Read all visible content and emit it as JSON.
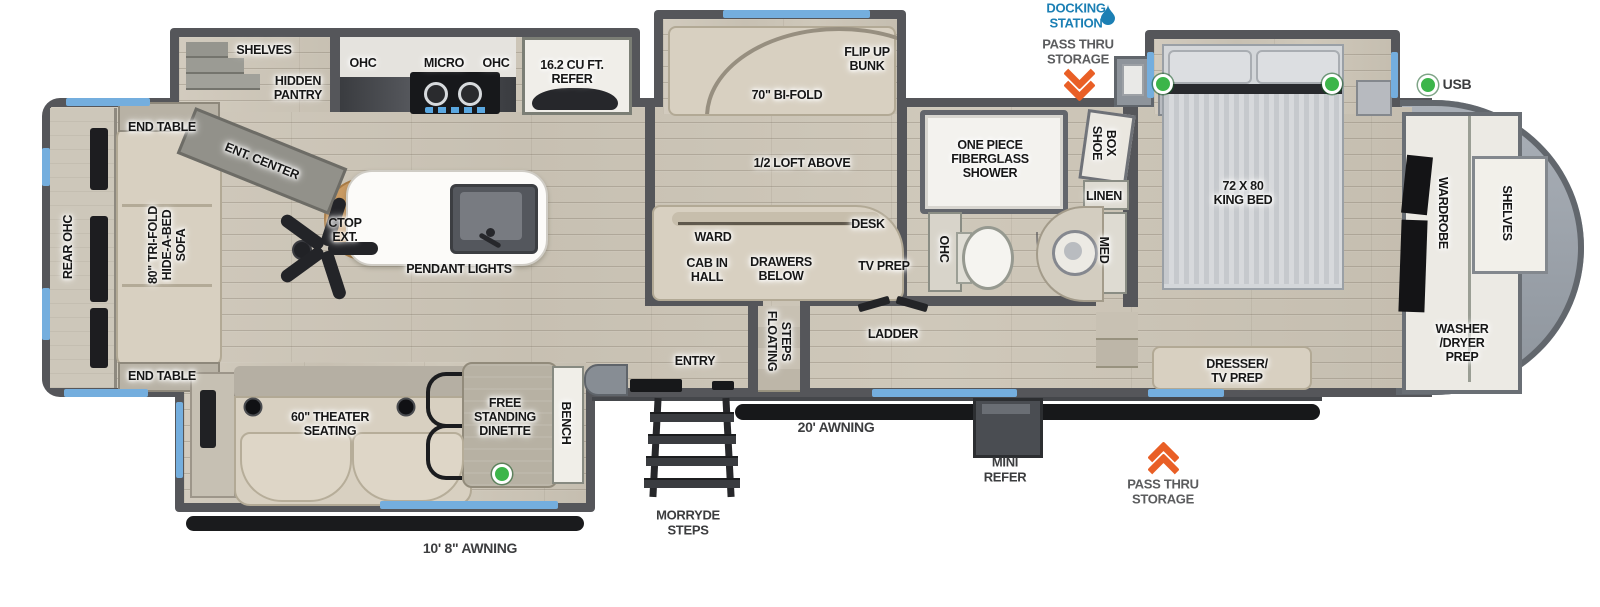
{
  "colors": {
    "window_blue": "#74aede",
    "docking_blue": "#1b7fb4",
    "accent_orange": "#e95f26",
    "indicator_green": "#3cb54a",
    "annotation_gray": "#5b5c5e",
    "wall_gray": "#55565a"
  },
  "icons": {
    "docking_station": "water-drop",
    "pass_thru_storage": "double-chevron-arrow",
    "power_indicator": "green-dot"
  },
  "labels": {
    "shelves": "SHELVES",
    "hidden_pantry": "HIDDEN\nPANTRY",
    "ent_center": "ENT. CENTER",
    "ohc_left": "OHC",
    "micro": "MICRO",
    "ohc_right": "OHC",
    "refer": "16.2 CU FT.\nREFER",
    "end_table_top": "END TABLE",
    "rear_ohc": "REAR OHC",
    "sofa": "80\" TRI-FOLD\nHIDE-A-BED\nSOFA",
    "end_table_bottom": "END TABLE",
    "ctop_ext": "CTOP\nEXT.",
    "pendant_lights": "PENDANT LIGHTS",
    "flip_up_bunk": "FLIP UP\nBUNK",
    "bi_fold": "70\" BI-FOLD",
    "loft_above": "1/2 LOFT ABOVE",
    "ward": "WARD",
    "cab_in_hall": "CAB IN\nHALL",
    "drawers_below": "DRAWERS\nBELOW",
    "desk": "DESK",
    "tv_prep": "TV PREP",
    "floating_steps": "FLOATING\nSTEPS",
    "ladder": "LADDER",
    "entry": "ENTRY",
    "shower": "ONE PIECE\nFIBERGLASS\nSHOWER",
    "shoe_box": "SHOE\nBOX",
    "linen": "LINEN",
    "ohc_bath": "OHC",
    "med": "MED",
    "king_bed": "72 X 80\nKING BED",
    "dresser": "DRESSER/\nTV PREP",
    "wardrobe": "WARDROBE",
    "shelves_front": "SHELVES",
    "washer_dryer": "WASHER\n/DRYER\nPREP",
    "theater": "60\" THEATER\nSEATING",
    "dinette": "FREE\nSTANDING\nDINETTE",
    "bench": "BENCH",
    "docking_station": "DOCKING\nSTATION",
    "pass_thru_top": "PASS THRU\nSTORAGE",
    "pass_thru_bottom": "PASS THRU\nSTORAGE",
    "usb": "USB",
    "awning_20": "20' AWNING",
    "awning_10": "10' 8\" AWNING",
    "mini_refer": "MINI\nREFER",
    "morryde": "MORRYDE\nSTEPS"
  }
}
